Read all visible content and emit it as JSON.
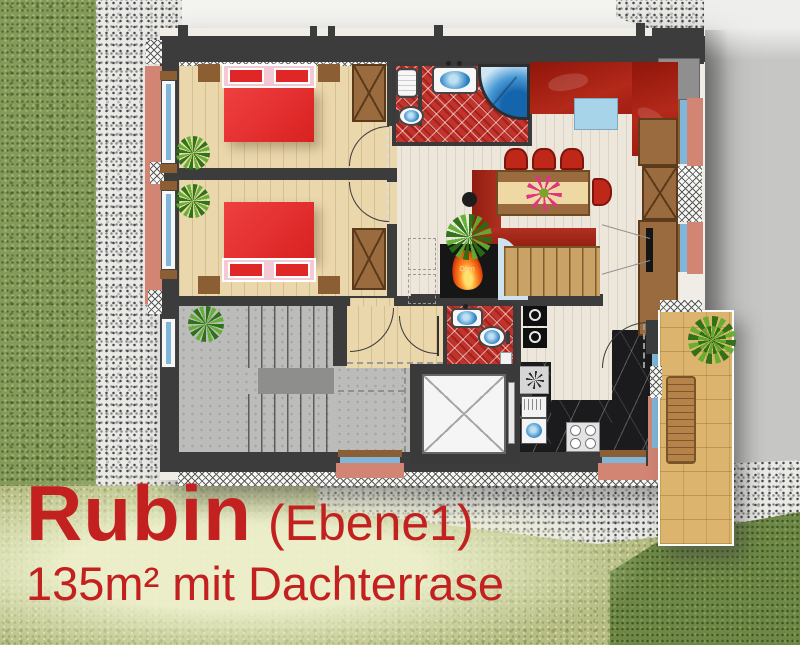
{
  "caption": {
    "title": "Rubin",
    "level": "(Ebene1)",
    "subtitle": "135m² mit Dachterrase"
  },
  "labels": {
    "fireplace": "Ofen"
  },
  "palette": {
    "accent_red": "#c32020",
    "wall_dark": "#3c3c3c",
    "grass_green": "#84995a",
    "grass_light": "#b6bc83",
    "grass_dark": "#6f8847",
    "gravel_gray": "#e9e9e6",
    "outside_gray": "#c6c6c5",
    "bedroom_floor": "#ead7ac",
    "bath_tile_red": "#c0342c",
    "living_floor": "#ece7da",
    "sofa_red": "#a31d12",
    "bed_red": "#e53030",
    "furniture_brown": "#9a6b3f",
    "kitchen_marble": "#1b1b1d",
    "terrace_wood": "#dcb46e",
    "facade_salmon": "#d28573",
    "window_blue": "#7fb6d9"
  }
}
